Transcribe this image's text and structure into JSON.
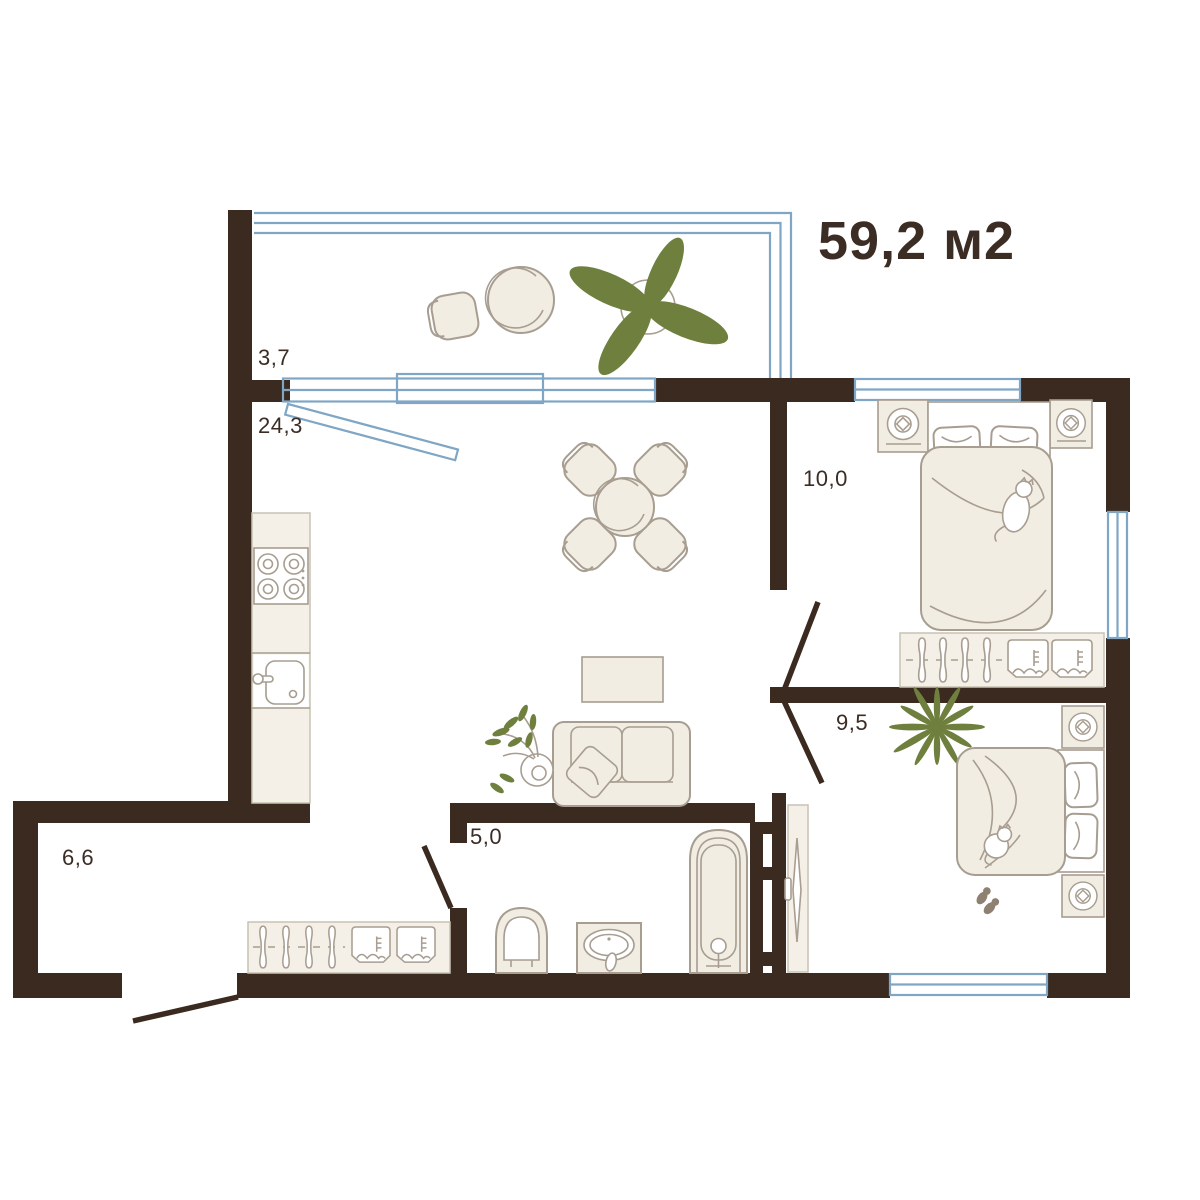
{
  "title": "59,2 м2",
  "rooms": {
    "balcony": {
      "name": "balcony",
      "area_label": "3,7"
    },
    "living_room": {
      "name": "living-room-kitchen",
      "area_label": "24,3"
    },
    "bedroom_primary": {
      "name": "bedroom-primary",
      "area_label": "10,0"
    },
    "bedroom_secondary": {
      "name": "bedroom-secondary",
      "area_label": "9,5"
    },
    "bathroom": {
      "name": "bathroom",
      "area_label": "5,0"
    },
    "hallway": {
      "name": "hallway",
      "area_label": "6,6"
    }
  },
  "icons": [
    "double-bed-icon",
    "nightstand-lamp-icon",
    "wardrobe-hangers-icon",
    "clothes-box-icon",
    "sofa-icon",
    "pillow-icon",
    "coffee-table-icon",
    "dining-table-icon",
    "chair-icon",
    "stove-icon",
    "kitchen-sink-icon",
    "bathtub-icon",
    "toilet-icon",
    "washbasin-icon",
    "mirror-door-icon",
    "plant-icon",
    "palm-plant-icon",
    "cat-icon",
    "slippers-icon",
    "balcony-glazing-icon",
    "window-icon",
    "door-leaf-icon"
  ],
  "colors": {
    "bg": "#ffffff",
    "wall": "#3a2a20",
    "window": "#7fa6c5",
    "furniture-fill": "#f2ede2",
    "furniture-stroke": "#a79d90",
    "panel-fill": "#f5f0e7",
    "plant": "#6f7f3e",
    "slipper": "#8e8172",
    "text": "#3b2c24"
  }
}
